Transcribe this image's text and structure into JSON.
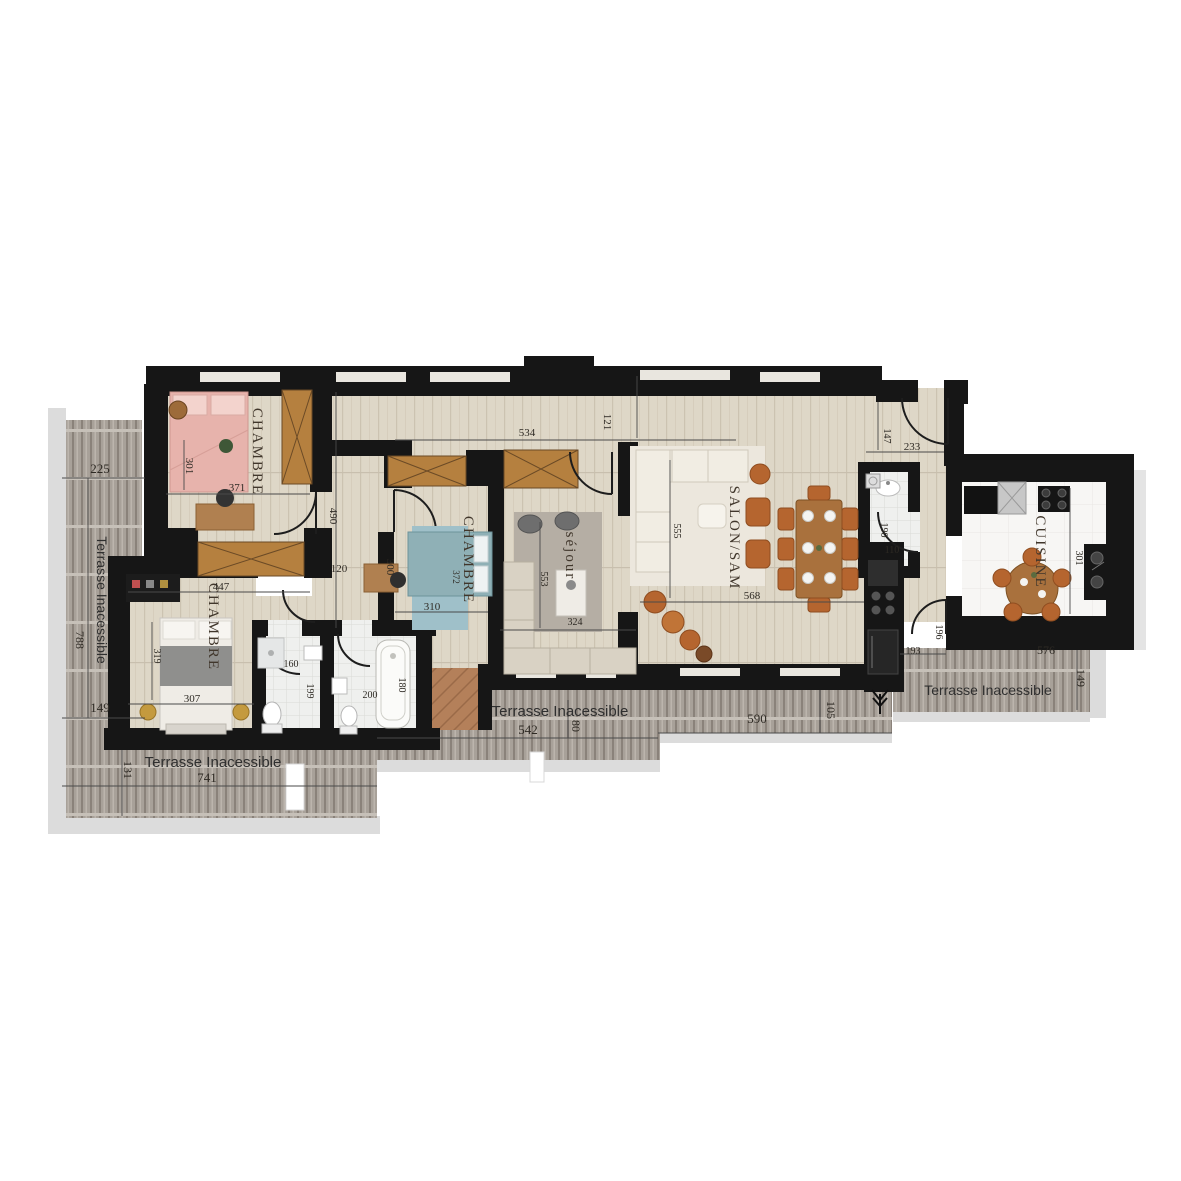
{
  "plan_title": "Plan d'appartement",
  "rooms": {
    "chambre1": {
      "label": "CHAMBRE",
      "d_h": "301",
      "d_w": "371"
    },
    "chambre2": {
      "label": "CHAMBRE",
      "d_h": "300",
      "d_w": "310",
      "d_diag": "372"
    },
    "chambre3": {
      "label": "CHAMBRE",
      "d_top": "447",
      "d_h": "319",
      "d_w": "307"
    },
    "sejour": {
      "label": "séjour",
      "d_h": "553",
      "d_w": "324"
    },
    "salon": {
      "label": "SALON/SAM",
      "d_h": "555",
      "d_w": "568"
    },
    "cuisine": {
      "label": "CUISINE",
      "d_h": "301"
    },
    "hall": {
      "d_h": "147",
      "d_w": "233"
    },
    "wc_entree": {
      "d_h": "190",
      "d_w": "110"
    },
    "couloir": {
      "d_len": "490",
      "d_pass": "120",
      "d_w": "534",
      "d_h": "121"
    },
    "couloir_cuisine": {
      "d_h": "196",
      "d_w": "193"
    },
    "wc": {
      "d_w": "160",
      "d_h": "199"
    },
    "salle_bain": {
      "d_w": "200",
      "d_h": "180"
    }
  },
  "terraces": {
    "left": {
      "label": "Terrasse Inacessible",
      "d_top": "225",
      "d_h": "788",
      "d_mid": "149",
      "d_low": "131"
    },
    "bottom_left": {
      "label": "Terrasse Inacessible",
      "d_w": "741"
    },
    "bottom_center": {
      "label": "Terrasse Inacessible",
      "d_w": "542",
      "d_step": "80"
    },
    "bottom_salon": {
      "d_w": "590",
      "d_step": "105"
    },
    "right": {
      "label": "Terrasse Inacessible",
      "d_w": "576",
      "d_h": "149"
    }
  },
  "colors": {
    "wall": "#161616",
    "floor_wood": "#ded7c7",
    "terrace": "#a8a199",
    "wardrobe": "#b5803f",
    "rust": "#b5652f",
    "shadow": "#dcdcdc"
  }
}
